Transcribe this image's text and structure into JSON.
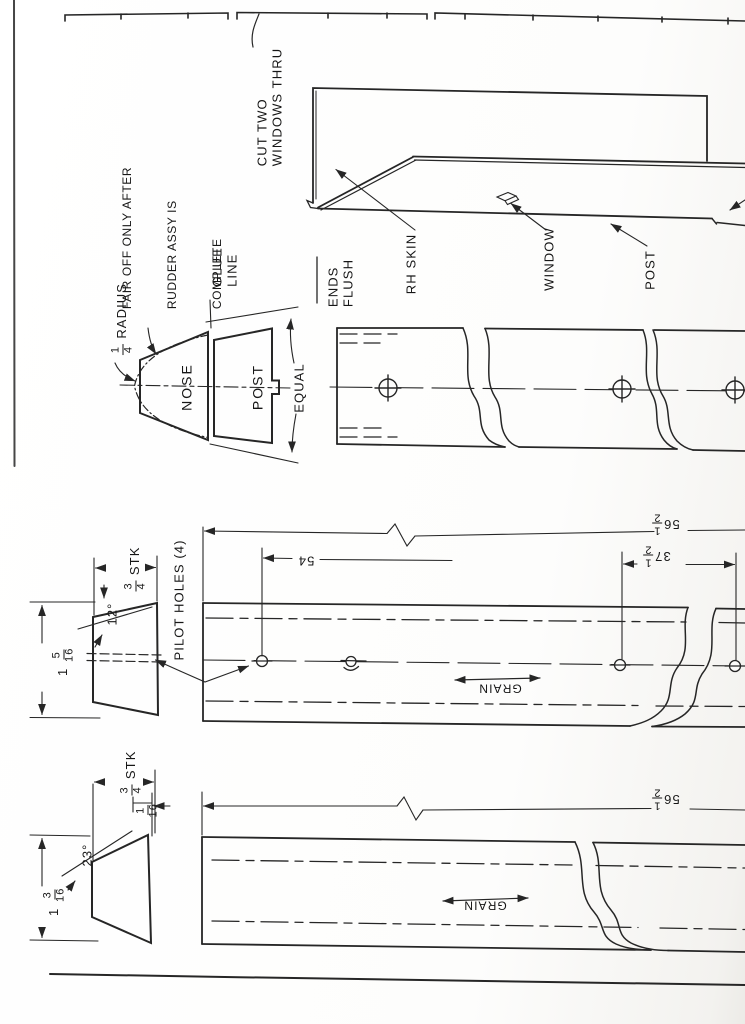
{
  "page": {
    "ink": "#262626",
    "paper": "#fdfdfc"
  },
  "top_note": {
    "line1": "CUT TWO",
    "line2": "WINDOWS THRU"
  },
  "assembly": {
    "rh_skin": "RH SKIN",
    "window": "WINDOW",
    "post": "POST",
    "ends_flush_line1": "ENDS",
    "ends_flush_line2": "FLUSH"
  },
  "nose_detail": {
    "fair_note_line1": "FAIR OFF ONLY AFTER",
    "fair_note_line2": "RUDDER ASSY IS",
    "fair_note_line3": "COMPLETE",
    "glue_word1": "GLUE",
    "glue_word2": "LINE",
    "radius_num": "1",
    "radius_den": "4",
    "radius_word": " RADIUS",
    "nose": "NOSE",
    "post": "POST",
    "equal": "EQUAL"
  },
  "mid_profile": {
    "stk_num": "3",
    "stk_den": "4",
    "stk_word": " STK",
    "angle": "12°",
    "height_whole": "1 ",
    "height_num": "5",
    "height_den": "16"
  },
  "mid_board": {
    "pilot_holes": "PILOT HOLES (4)",
    "dim_54": "54",
    "dim_37_whole": "37",
    "dim_37_num": "1",
    "dim_37_den": "2",
    "dim_56_whole": "56",
    "dim_56_num": "1",
    "dim_56_den": "2",
    "grain": "GRAIN"
  },
  "bot_profile": {
    "stk_num": "3",
    "stk_den": "4",
    "stk_word": " STK",
    "offset_num": "1",
    "offset_den": "16",
    "angle": "23°",
    "height_whole": "1 ",
    "height_num": "3",
    "height_den": "16"
  },
  "bot_board": {
    "dim_56_whole": "56",
    "dim_56_num": "1",
    "dim_56_den": "2",
    "grain": "GRAIN"
  }
}
